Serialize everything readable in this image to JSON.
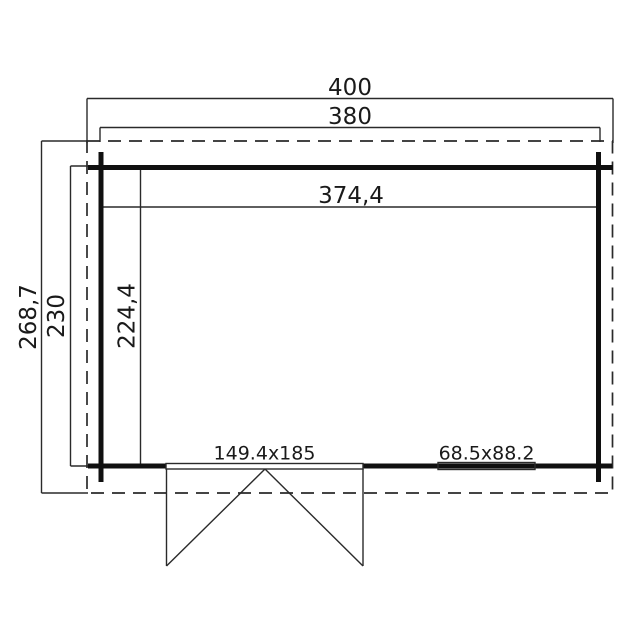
{
  "floorplan": {
    "description": "Top-view floor plan of a rectangular garden cabin with roof overhang, double door and one window",
    "colors": {
      "background": "#ffffff",
      "line": "#1a1a1a"
    },
    "dimensions": {
      "roof_width": "400",
      "wall_width": "380",
      "interior_width": "374,4",
      "roof_depth": "268,7",
      "wall_depth": "230",
      "interior_depth": "224,4"
    },
    "door": {
      "size_label": "149.4x185"
    },
    "window": {
      "size_label": "68.5x88.2"
    }
  }
}
